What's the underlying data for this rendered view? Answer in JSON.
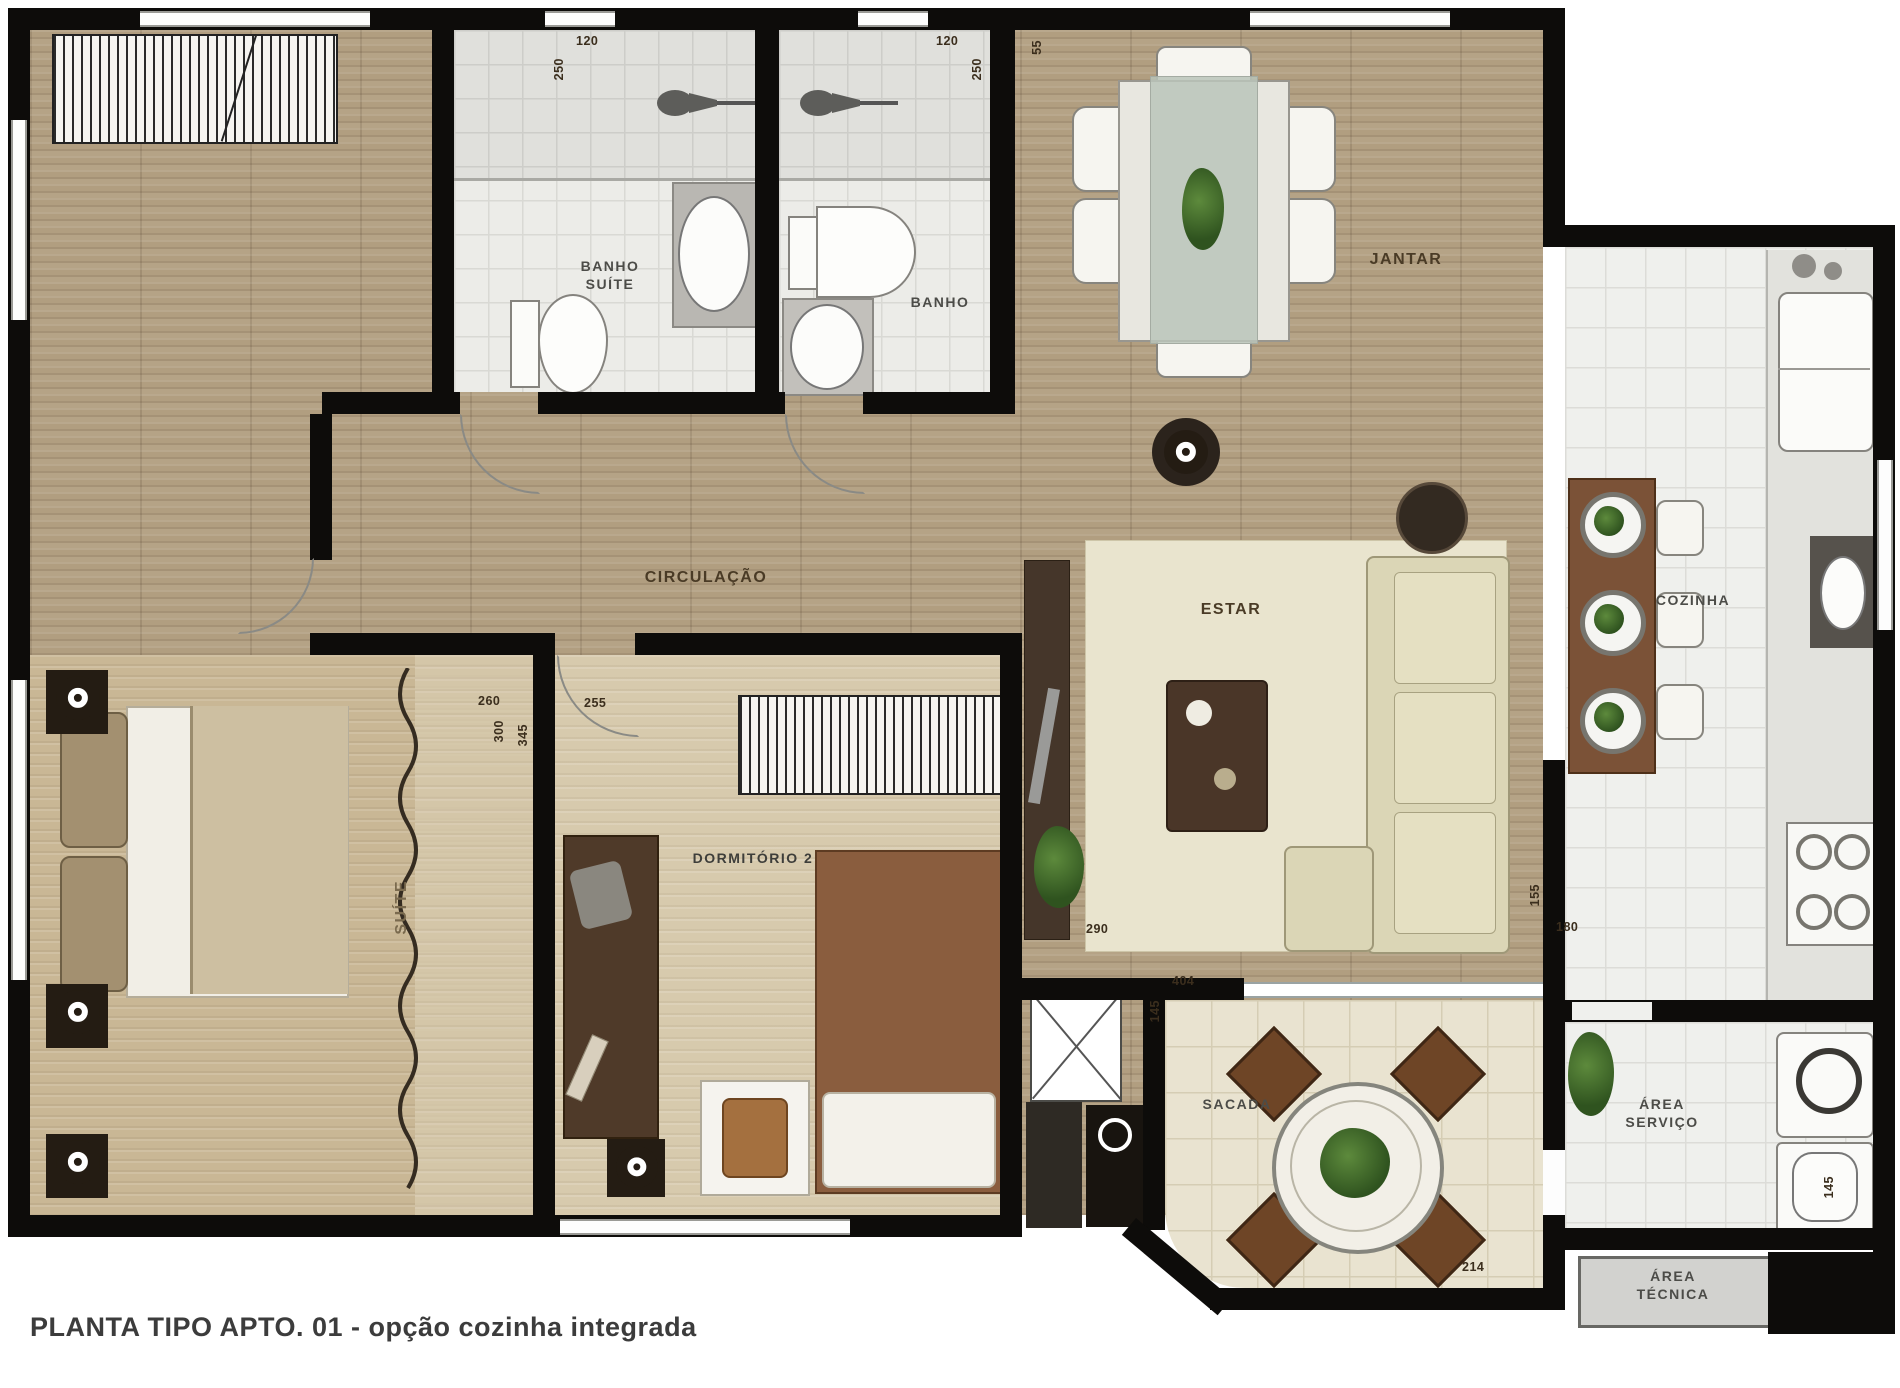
{
  "title": "PLANTA TIPO APTO. 01 - opção cozinha integrada",
  "rooms": {
    "suite": "SUÍTE",
    "banho_suite": "BANHO\nSUÍTE",
    "banho": "BANHO",
    "jantar": "JANTAR",
    "circulacao": "CIRCULAÇÃO",
    "estar": "ESTAR",
    "cozinha": "COZINHA",
    "dormitorio2": "DORMITÓRIO 2",
    "sacada": "SACADA",
    "area_servico": "ÁREA\nSERVIÇO",
    "area_tecnica": "ÁREA\nTÉCNICA"
  },
  "dims": [
    {
      "t": "120"
    },
    {
      "t": "250"
    },
    {
      "t": "120"
    },
    {
      "t": "250"
    },
    {
      "t": "55"
    },
    {
      "t": "260"
    },
    {
      "t": "300"
    },
    {
      "t": "255"
    },
    {
      "t": "345"
    },
    {
      "t": "404"
    },
    {
      "t": "145"
    },
    {
      "t": "290"
    },
    {
      "t": "155"
    },
    {
      "t": "180"
    },
    {
      "t": "214"
    },
    {
      "t": "145"
    }
  ],
  "colors": {
    "wall": "#0d0c0a",
    "wood": "#b19e80",
    "accent_brown": "#7b5237",
    "label": "#4a3b26"
  }
}
